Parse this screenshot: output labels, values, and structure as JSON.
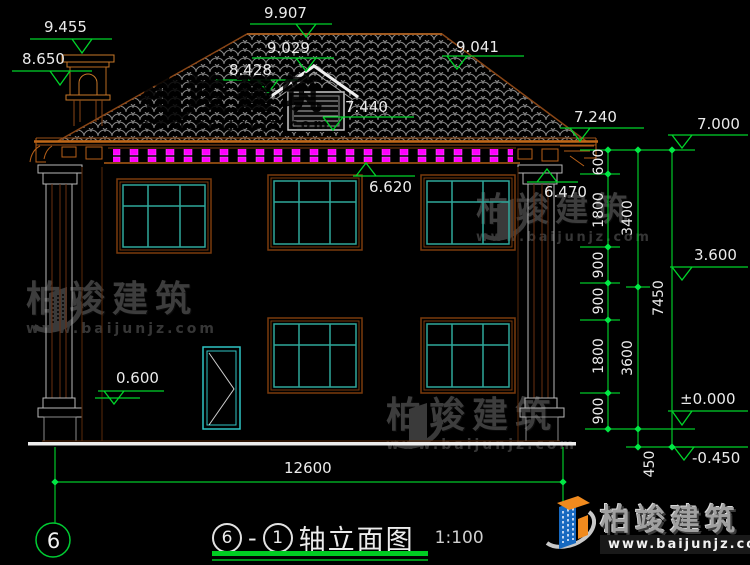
{
  "title": {
    "axis_start": "6",
    "dash": "-",
    "axis_end": "1",
    "name": "轴立面图",
    "scale": "1:100"
  },
  "axis_bubble": {
    "label": "6"
  },
  "elevations": {
    "e9455": "9.455",
    "e8650": "8.650",
    "e9907": "9.907",
    "e9029": "9.029",
    "e8428": "8.428",
    "e7440": "7.440",
    "e9041": "9.041",
    "e7240": "7.240",
    "e7000": "7.000",
    "e6620": "6.620",
    "e6470": "6.470",
    "e3600": "3.600",
    "e0000": "±0.000",
    "em0450": "-0.450",
    "e0600": "0.600"
  },
  "dimensions": {
    "right_inner": [
      "600",
      "1800",
      "900",
      "900",
      "1800",
      "900"
    ],
    "right_mid": [
      "3400",
      "3600",
      "450"
    ],
    "right_outer": [
      "7450"
    ],
    "bottom": [
      "12600"
    ]
  },
  "watermark": {
    "brand": "柏竣建筑",
    "url": "www.baijunjz.com"
  },
  "logo": {
    "brand": "柏竣建筑",
    "url": "www.baijunjz.com"
  },
  "colors": {
    "dim_green": "#00c828",
    "accent_magenta": "#ff00ff",
    "frame_orange": "#b05c14",
    "glass_teal": "#2fa79a"
  }
}
